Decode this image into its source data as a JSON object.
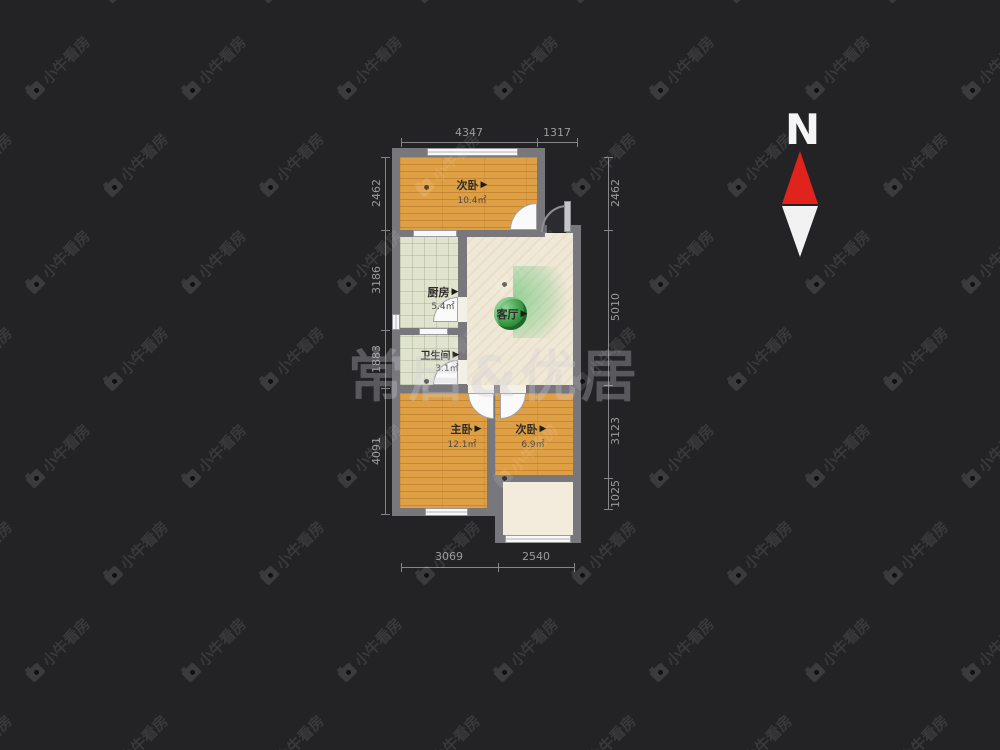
{
  "watermark": {
    "tile_text": "小牛看房",
    "center_text": "常启&优居"
  },
  "compass": {
    "label": "N"
  },
  "icons": {
    "door_direction": "▶"
  },
  "rooms": {
    "bedroom_top": {
      "name": "次卧",
      "area": "10.4㎡"
    },
    "kitchen": {
      "name": "厨房",
      "area": "5.4㎡"
    },
    "bathroom": {
      "name": "卫生间",
      "area": "3.1㎡"
    },
    "living": {
      "name": "客厅"
    },
    "master": {
      "name": "主卧",
      "area": "12.1㎡"
    },
    "bedroom_bottom": {
      "name": "次卧",
      "area": "6.9㎡"
    }
  },
  "dimensions": {
    "top": [
      "4347",
      "1317"
    ],
    "bottom": [
      "3069",
      "2540"
    ],
    "left": [
      "2462",
      "3186",
      "1883",
      "4091"
    ],
    "right": [
      "2462",
      "5010",
      "3123",
      "1025"
    ]
  },
  "colors": {
    "background": "#232325",
    "wall": "#77777c",
    "bedroom_floor": "#df9f45",
    "tile_floor": "#e0e4cf",
    "living_floor": "#f0e8d6",
    "balcony_floor": "#f3ecdc",
    "dimension_text": "#9b9b9b",
    "north_red": "#e0231c"
  }
}
